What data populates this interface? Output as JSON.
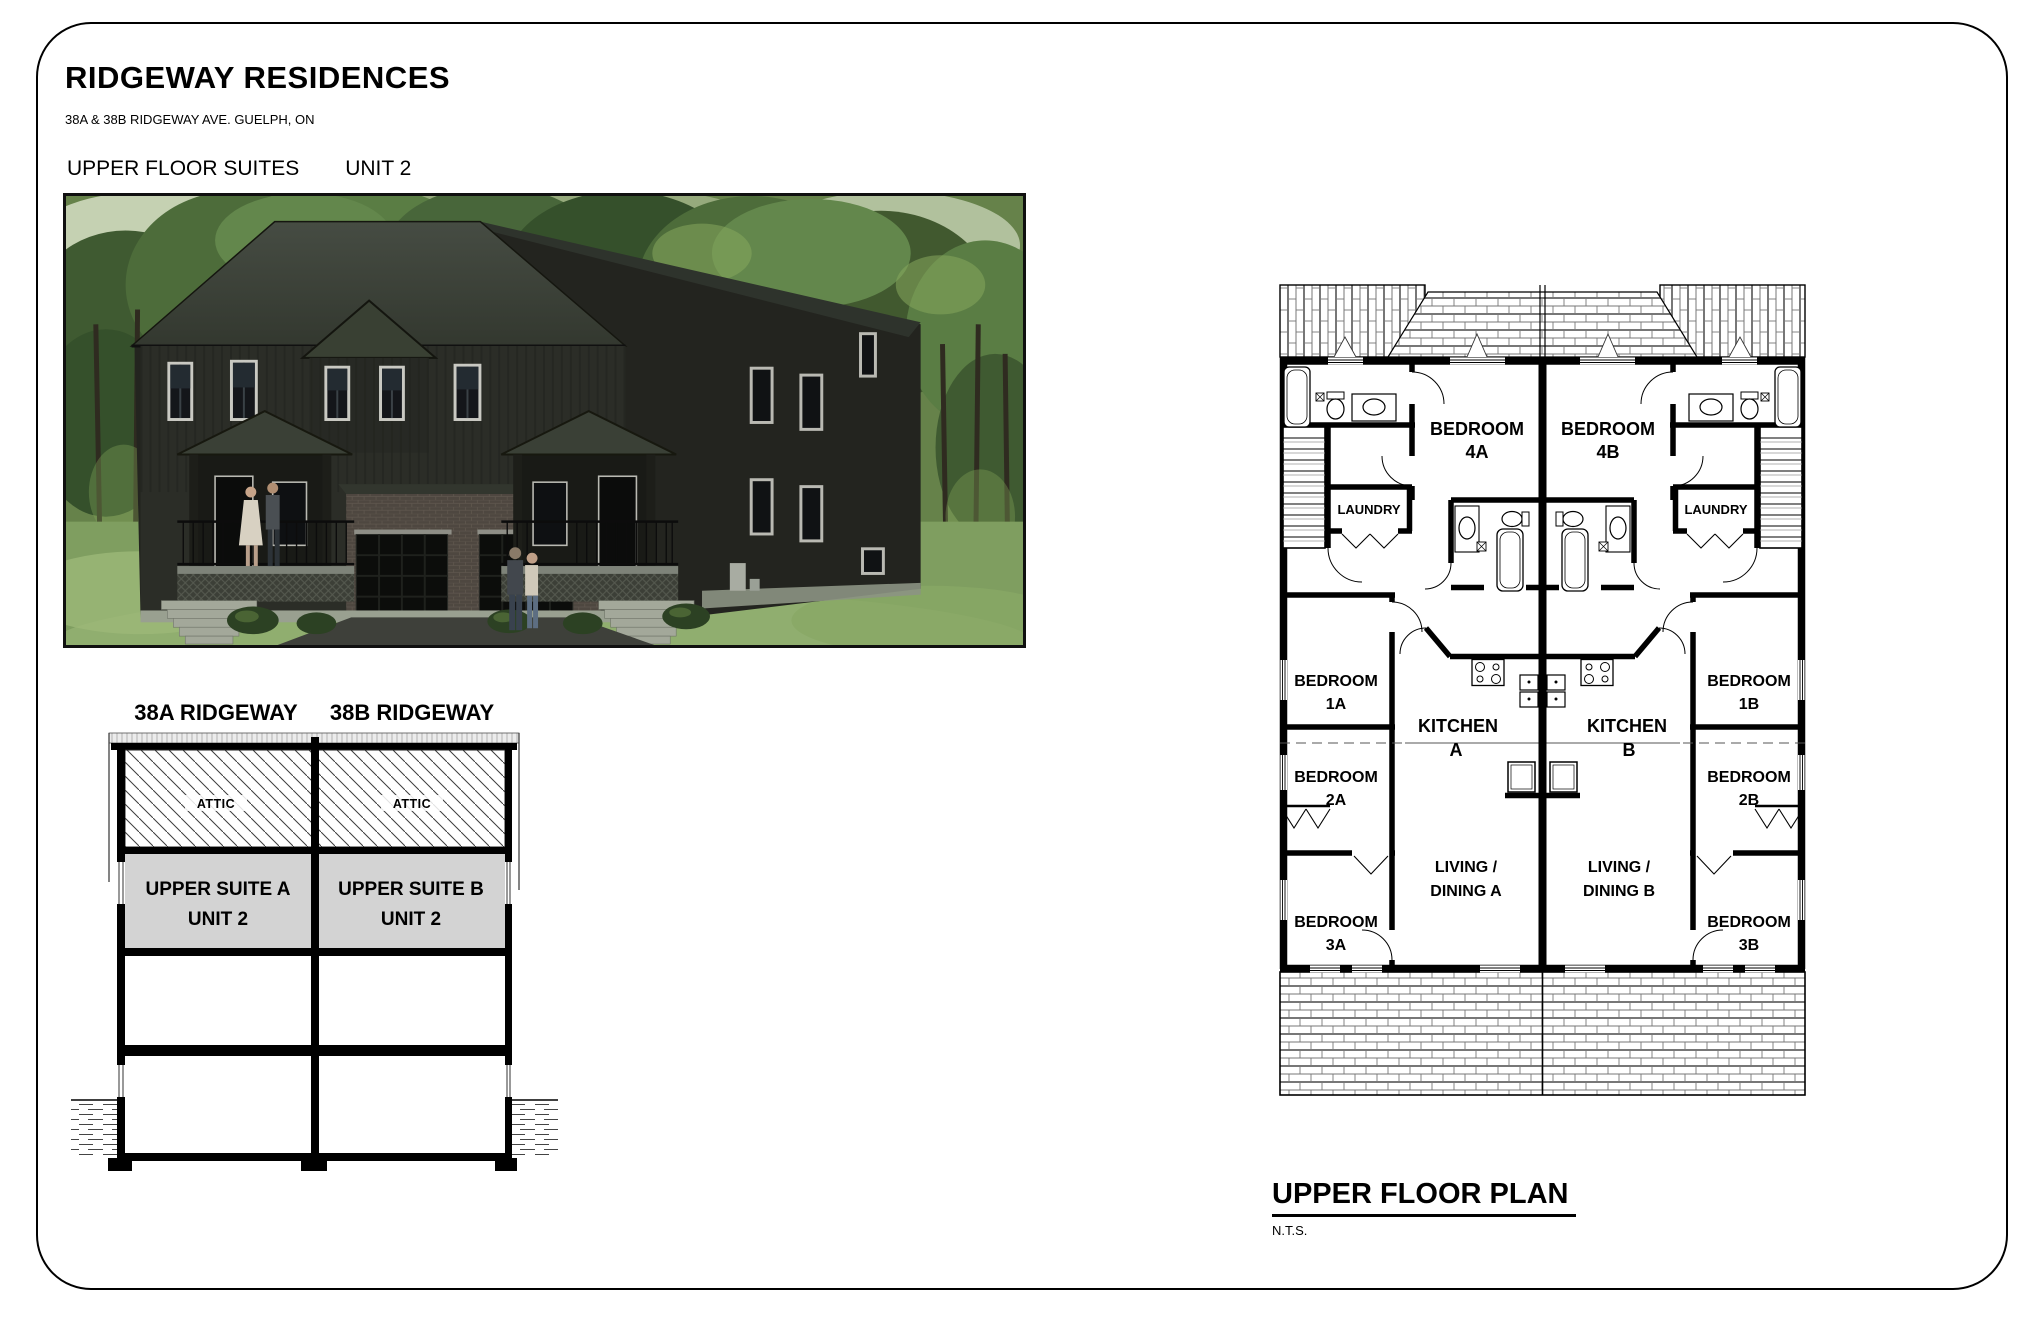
{
  "page": {
    "title": "RIDGEWAY RESIDENCES",
    "subtitle": "38A & 38B RIDGEWAY AVE. GUELPH, ON",
    "sheet_label": "UPPER FLOOR SUITES",
    "sheet_unit": "UNIT 2"
  },
  "section": {
    "header_a": "38A RIDGEWAY",
    "header_b": "38B RIDGEWAY",
    "attic_a": "ATTIC",
    "attic_b": "ATTIC",
    "suite_a_line1": "UPPER SUITE A",
    "suite_a_line2": "UNIT 2",
    "suite_b_line1": "UPPER SUITE B",
    "suite_b_line2": "UNIT 2"
  },
  "plan": {
    "title": "UPPER FLOOR PLAN",
    "scale": "N.T.S.",
    "rooms": {
      "bedroom4a": [
        "BEDROOM",
        "4A"
      ],
      "bedroom4b": [
        "BEDROOM",
        "4B"
      ],
      "laundry_a": "LAUNDRY",
      "laundry_b": "LAUNDRY",
      "bedroom1a": [
        "BEDROOM",
        "1A"
      ],
      "bedroom1b": [
        "BEDROOM",
        "1B"
      ],
      "kitchen_a": [
        "KITCHEN",
        "A"
      ],
      "kitchen_b": [
        "KITCHEN",
        "B"
      ],
      "bedroom2a": [
        "BEDROOM",
        "2A"
      ],
      "bedroom2b": [
        "BEDROOM",
        "2B"
      ],
      "living_a": [
        "LIVING /",
        "DINING A"
      ],
      "living_b": [
        "LIVING /",
        "DINING B"
      ],
      "bedroom3a": [
        "BEDROOM",
        "3A"
      ],
      "bedroom3b": [
        "BEDROOM",
        "3B"
      ]
    }
  },
  "colors": {
    "paper": "#ffffff",
    "line": "#000000",
    "suite_fill": "#d3d3d3",
    "house_wall": "#2b2d27",
    "house_roof": "#3d433b",
    "foliage": "#4d6c3a",
    "grass": "#7f9e60"
  }
}
